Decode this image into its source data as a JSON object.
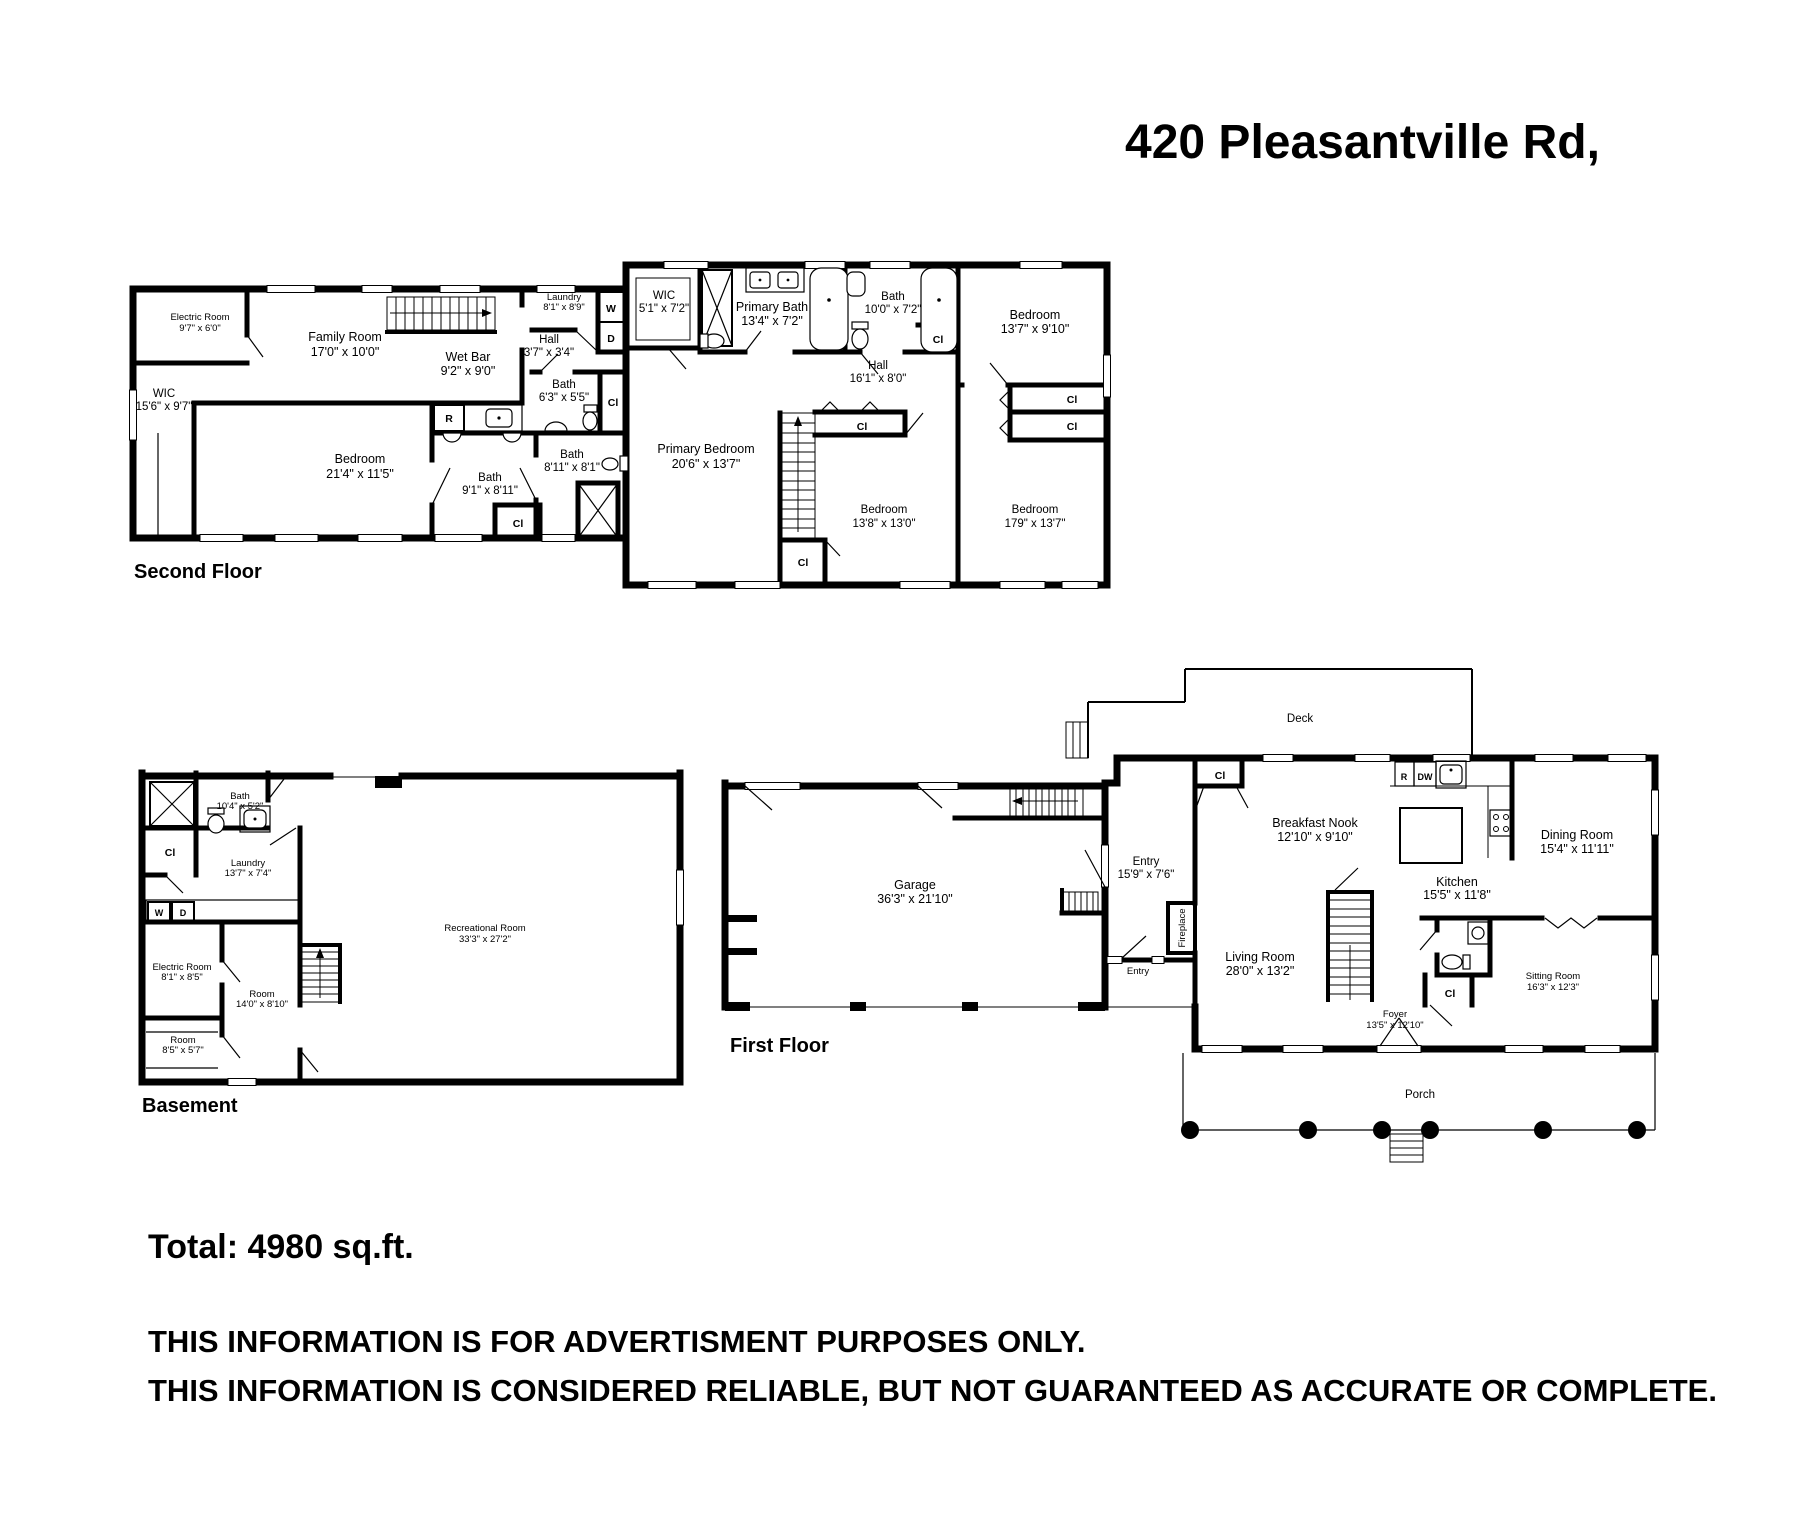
{
  "title": "420 Pleasantville Rd,",
  "summary": {
    "total": "Total: 4980 sq.ft.",
    "disclaimer1": "THIS INFORMATION IS FOR ADVERTISMENT PURPOSES ONLY.",
    "disclaimer2": "THIS INFORMATION IS CONSIDERED RELIABLE, BUT NOT GUARANTEED AS ACCURATE OR COMPLETE."
  },
  "tags": {
    "washer": "W",
    "dryer": "D",
    "refrigerator": "R",
    "dishwasher": "DW",
    "closet": "Cl"
  },
  "second_floor": {
    "label": "Second Floor",
    "rooms": {
      "electric_room": {
        "name": "Electric Room",
        "dims": "9'7\" x 6'0\""
      },
      "family_room": {
        "name": "Family Room",
        "dims": "17'0\" x 10'0\""
      },
      "wet_bar": {
        "name": "Wet Bar",
        "dims": "9'2\" x 9'0\""
      },
      "wic_left": {
        "name": "WIC",
        "dims": "15'6\" x 9'7\""
      },
      "bedroom_left": {
        "name": "Bedroom",
        "dims": "21'4\" x 11'5\""
      },
      "bath_left": {
        "name": "Bath",
        "dims": "9'1\" x 8'11\""
      },
      "hall_small": {
        "name": "Hall",
        "dims": "3'7\" x 3'4\""
      },
      "laundry": {
        "name": "Laundry",
        "dims": "8'1\" x 8'9\""
      },
      "bath_hall": {
        "name": "Bath",
        "dims": "6'3\" x 5'5\""
      },
      "bath_mid": {
        "name": "Bath",
        "dims": "8'11\" x 8'1\""
      },
      "wic_primary": {
        "name": "WIC",
        "dims": "5'1\" x 7'2\""
      },
      "primary_bath": {
        "name": "Primary Bath",
        "dims": "13'4\" x 7'2\""
      },
      "bath_right": {
        "name": "Bath",
        "dims": "10'0\" x 7'2\""
      },
      "bedroom_top_right": {
        "name": "Bedroom",
        "dims": "13'7\" x 9'10\""
      },
      "hall_right": {
        "name": "Hall",
        "dims": "16'1\" x 8'0\""
      },
      "primary_bedroom": {
        "name": "Primary Bedroom",
        "dims": "20'6\" x 13'7\""
      },
      "bedroom_bottom_center": {
        "name": "Bedroom",
        "dims": "13'8\" x 13'0\""
      },
      "bedroom_bottom_right": {
        "name": "Bedroom",
        "dims": "179\" x 13'7\""
      }
    }
  },
  "basement": {
    "label": "Basement",
    "rooms": {
      "bath": {
        "name": "Bath",
        "dims": "10'4\" x 5'2\""
      },
      "laundry": {
        "name": "Laundry",
        "dims": "13'7\" x 7'4\""
      },
      "electric_room": {
        "name": "Electric Room",
        "dims": "8'1\" x 8'5\""
      },
      "room_center": {
        "name": "Room",
        "dims": "14'0\" x 8'10\""
      },
      "room_small": {
        "name": "Room",
        "dims": "8'5\" x 5'7\""
      },
      "recreational_room": {
        "name": "Recreational Room",
        "dims": "33'3\" x 27'2\""
      }
    }
  },
  "first_floor": {
    "label": "First Floor",
    "rooms": {
      "garage": {
        "name": "Garage",
        "dims": "36'3\" x 21'10\""
      },
      "entry": {
        "name": "Entry",
        "dims": "15'9\" x 7'6\""
      },
      "entry_side": {
        "name": "Entry"
      },
      "fireplace": {
        "name": "Fireplace"
      },
      "deck": {
        "name": "Deck"
      },
      "porch": {
        "name": "Porch"
      },
      "breakfast_nook": {
        "name": "Breakfast Nook",
        "dims": "12'10\" x 9'10\""
      },
      "dining_room": {
        "name": "Dining Room",
        "dims": "15'4\" x 11'11\""
      },
      "kitchen": {
        "name": "Kitchen",
        "dims": "15'5\" x 11'8\""
      },
      "living_room": {
        "name": "Living Room",
        "dims": "28'0\" x 13'2\""
      },
      "sitting_room": {
        "name": "Sitting Room",
        "dims": "16'3\" x 12'3\""
      },
      "foyer": {
        "name": "Foyer",
        "dims": "13'5\" x 12'10\""
      }
    }
  }
}
